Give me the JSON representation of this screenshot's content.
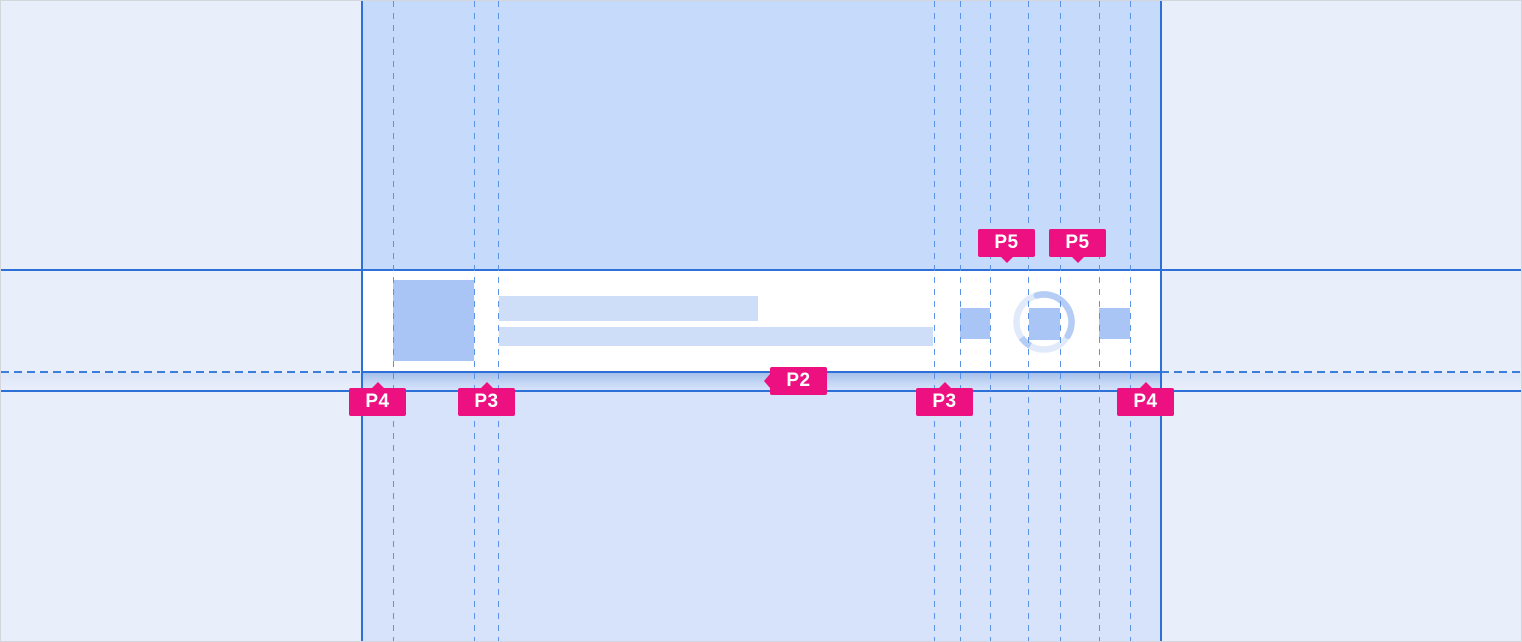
{
  "annotations": {
    "labels": [
      {
        "id": "p5-gap-left",
        "text": "P5",
        "arrow": "down"
      },
      {
        "id": "p5-gap-right",
        "text": "P5",
        "arrow": "down"
      },
      {
        "id": "p2-row-gap",
        "text": "P2",
        "arrow": "left"
      },
      {
        "id": "p4-left",
        "text": "P4",
        "arrow": "up"
      },
      {
        "id": "p3-left",
        "text": "P3",
        "arrow": "up"
      },
      {
        "id": "p3-right",
        "text": "P3",
        "arrow": "up"
      },
      {
        "id": "p4-right",
        "text": "P4",
        "arrow": "up"
      }
    ]
  },
  "colors": {
    "annotation_pink": "#ec1080",
    "annotation_text": "#ffffff",
    "guide_line_solid": "#2d70d7",
    "guide_line_dashed": "#5b93e6",
    "column_fill_top": "#c6dafb",
    "column_fill_bottom": "#d6e3fa",
    "margin_fill": "#e9eefb",
    "card_fill": "#ffffff",
    "placeholder_strong": "#a9c5f6",
    "placeholder_soft": "#cfdef8",
    "spinner_trail": "#e1eafb",
    "spinner_arc": "#b5cdf5"
  },
  "icons": {
    "spinner": "spinner-ring-icon",
    "avatar": "avatar-placeholder",
    "action_left": "action-icon-placeholder",
    "action_center": "action-icon-placeholder",
    "action_right": "action-icon-placeholder"
  }
}
